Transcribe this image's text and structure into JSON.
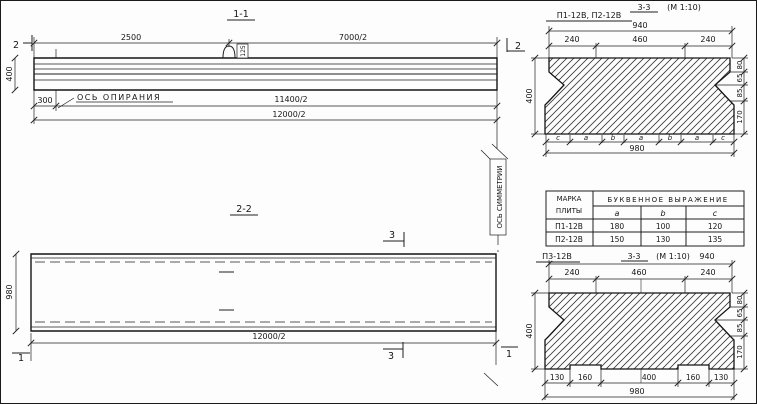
{
  "drawing": {
    "section_1_1": {
      "title": "1-1",
      "marker_left": "2",
      "marker_right": "2",
      "dim_2500": "2500",
      "dim_7000": "7000/2",
      "dim_height": "400",
      "dim_300": "300",
      "support_axis_label": "ОСЬ ОПИРАНИЯ",
      "hook_label": "125",
      "dim_11400": "11400/2",
      "dim_12000": "12000/2"
    },
    "symmetry_axis_label": "ОСЬ СИММЕТРИИ",
    "section_2_2": {
      "title": "2-2",
      "marker_3_top": "3",
      "marker_3_bottom": "3",
      "marker_1_left": "1",
      "marker_1_right": "1",
      "dim_height": "980",
      "dim_12000": "12000/2"
    },
    "section_3_3_top": {
      "label": "П1-12В, П2-12В",
      "title": "3-3",
      "scale": "(М 1:10)",
      "dim_total_top": "940",
      "dim_240_left": "240",
      "dim_460": "460",
      "dim_240_right": "240",
      "dim_height": "400",
      "right_dims": [
        "80",
        "65",
        "85",
        "170"
      ],
      "letters": [
        "c",
        "a",
        "b",
        "a",
        "b",
        "a",
        "c"
      ],
      "dim_total_bottom": "980"
    },
    "table": {
      "header_mark_line1": "МАРКА",
      "header_mark_line2": "ПЛИТЫ",
      "header_expression": "БУКВЕННОЕ ВЫРАЖЕНИЕ",
      "col_a": "a",
      "col_b": "b",
      "col_c": "c",
      "rows": [
        {
          "mark": "П1-12В",
          "a": "180",
          "b": "100",
          "c": "120"
        },
        {
          "mark": "П2-12В",
          "a": "150",
          "b": "130",
          "c": "135"
        }
      ]
    },
    "section_3_3_bottom": {
      "label": "П3-12В",
      "title": "3-3",
      "scale": "(М 1:10)",
      "dim_total_top": "940",
      "dim_240_left": "240",
      "dim_460": "460",
      "dim_240_right": "240",
      "dim_height": "400",
      "right_dims": [
        "80",
        "65",
        "85",
        "170"
      ],
      "bottom_dims": [
        "130",
        "160",
        "400",
        "160",
        "130"
      ],
      "dim_total_bottom": "980"
    }
  }
}
